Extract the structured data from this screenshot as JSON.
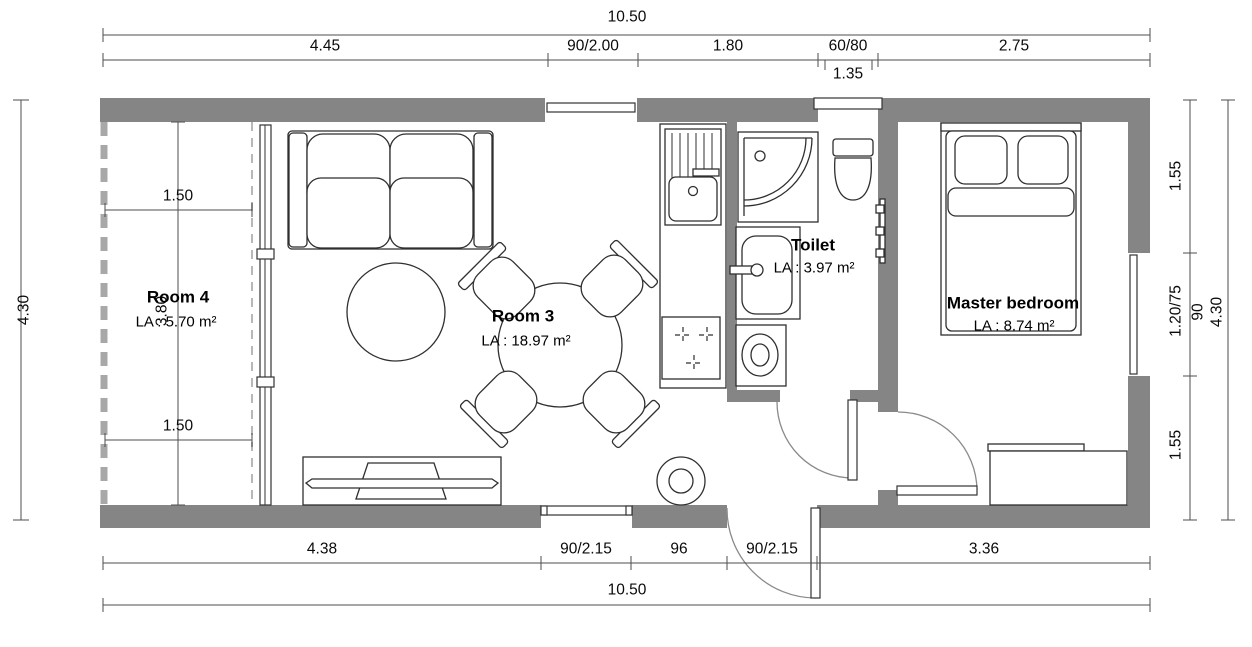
{
  "plan_title": "Floor plan 10.50 x 4.30",
  "rooms": {
    "room4": {
      "name": "Room 4",
      "area": "LA : 5.70 m²"
    },
    "room3": {
      "name": "Room 3",
      "area": "LA : 18.97 m²"
    },
    "toilet": {
      "name": "Toilet",
      "area": "LA : 3.97 m²"
    },
    "master": {
      "name": "Master bedroom",
      "area": "LA : 8.74 m²"
    }
  },
  "dimensions": {
    "top_overall": "10.50",
    "top_segments": [
      "4.45",
      "90/2.00",
      "1.80",
      "60/80",
      "2.75"
    ],
    "top_sub": "1.35",
    "bottom_segments": [
      "4.38",
      "90/2.15",
      "96",
      "90/2.15",
      "3.36"
    ],
    "bottom_overall": "10.50",
    "left_overall": "4.30",
    "right_segments": [
      "1.55",
      "1.20/75",
      "1.55"
    ],
    "right_window_width": "90",
    "right_overall": "4.30",
    "room4_width_top": "1.50",
    "room4_width_bottom": "1.50",
    "room4_height": "3.80"
  },
  "colors": {
    "wall": "#858585",
    "dashed_wall": "#a8a8a8",
    "dimension_line": "#4d4d4d",
    "furniture_line": "#2f2f2f",
    "text": "#000000"
  }
}
